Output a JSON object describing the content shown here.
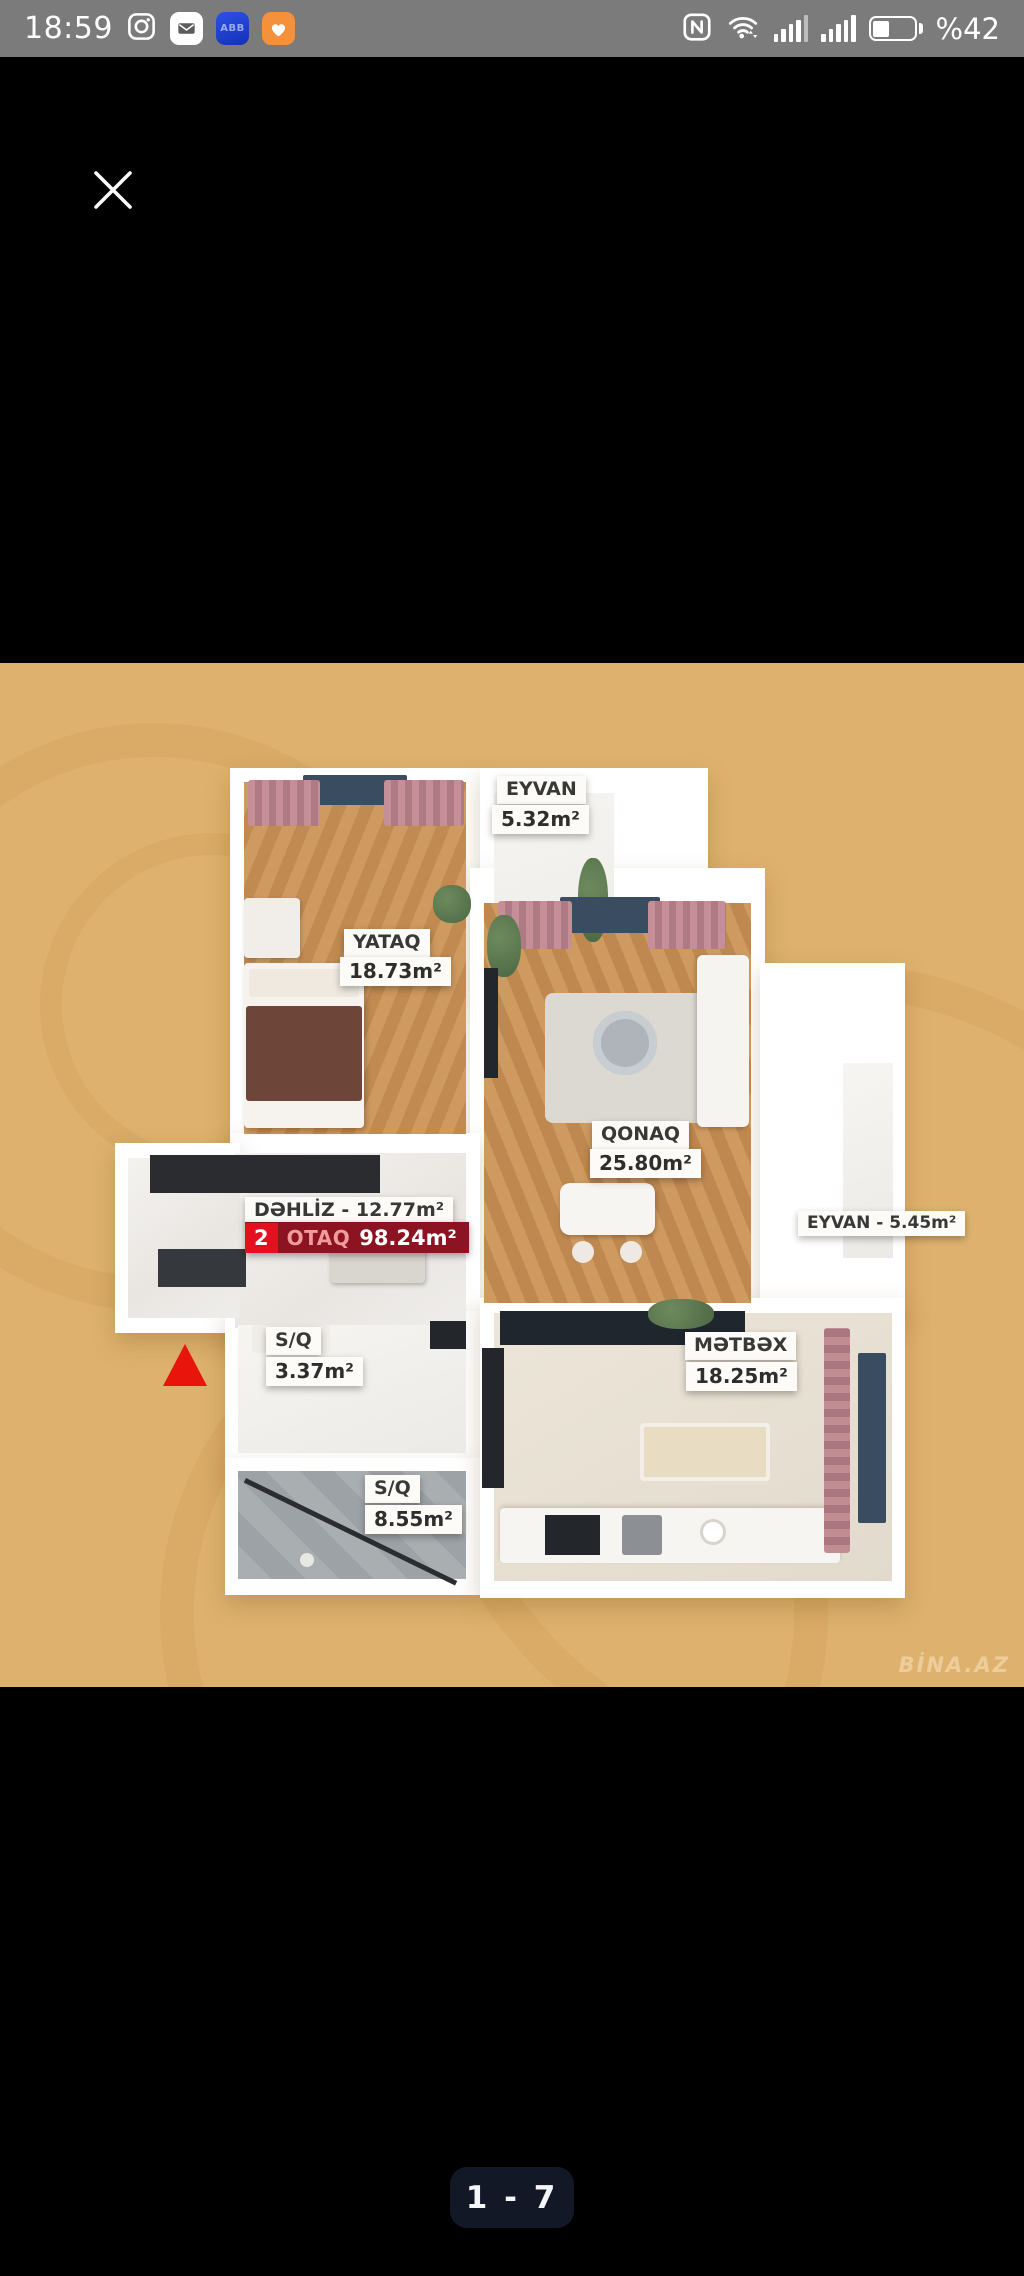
{
  "status_bar": {
    "time": "18:59",
    "battery_percent": "%42",
    "abb_badge_text": "ABB",
    "left_icons": [
      "instagram-icon",
      "mail-app-icon",
      "abb-app-icon",
      "health-app-icon"
    ],
    "right_icons": [
      "nfc-icon",
      "wifi-icon",
      "signal-sim1-icon",
      "signal-sim2-icon",
      "battery-icon"
    ]
  },
  "viewer": {
    "page_indicator": "1 - 7"
  },
  "floorplan": {
    "watermark": "BİNA.AZ",
    "summary": {
      "room_count": "2",
      "room_word": "OTAQ",
      "total_area": "98.24m²"
    },
    "dehliz_label": "DƏHLİZ - 12.77m²",
    "eyvan_right_label": "EYVAN - 5.45m²",
    "rooms": {
      "eyvan_top": {
        "name": "EYVAN",
        "area": "5.32m²"
      },
      "yataq": {
        "name": "YATAQ",
        "area": "18.73m²"
      },
      "qonaq": {
        "name": "QONAQ",
        "area": "25.80m²"
      },
      "sq_small": {
        "name": "S/Q",
        "area": "3.37m²"
      },
      "metbex": {
        "name": "MƏTBƏX",
        "area": "18.25m²"
      },
      "sq_large": {
        "name": "S/Q",
        "area": "8.55m²"
      }
    }
  }
}
